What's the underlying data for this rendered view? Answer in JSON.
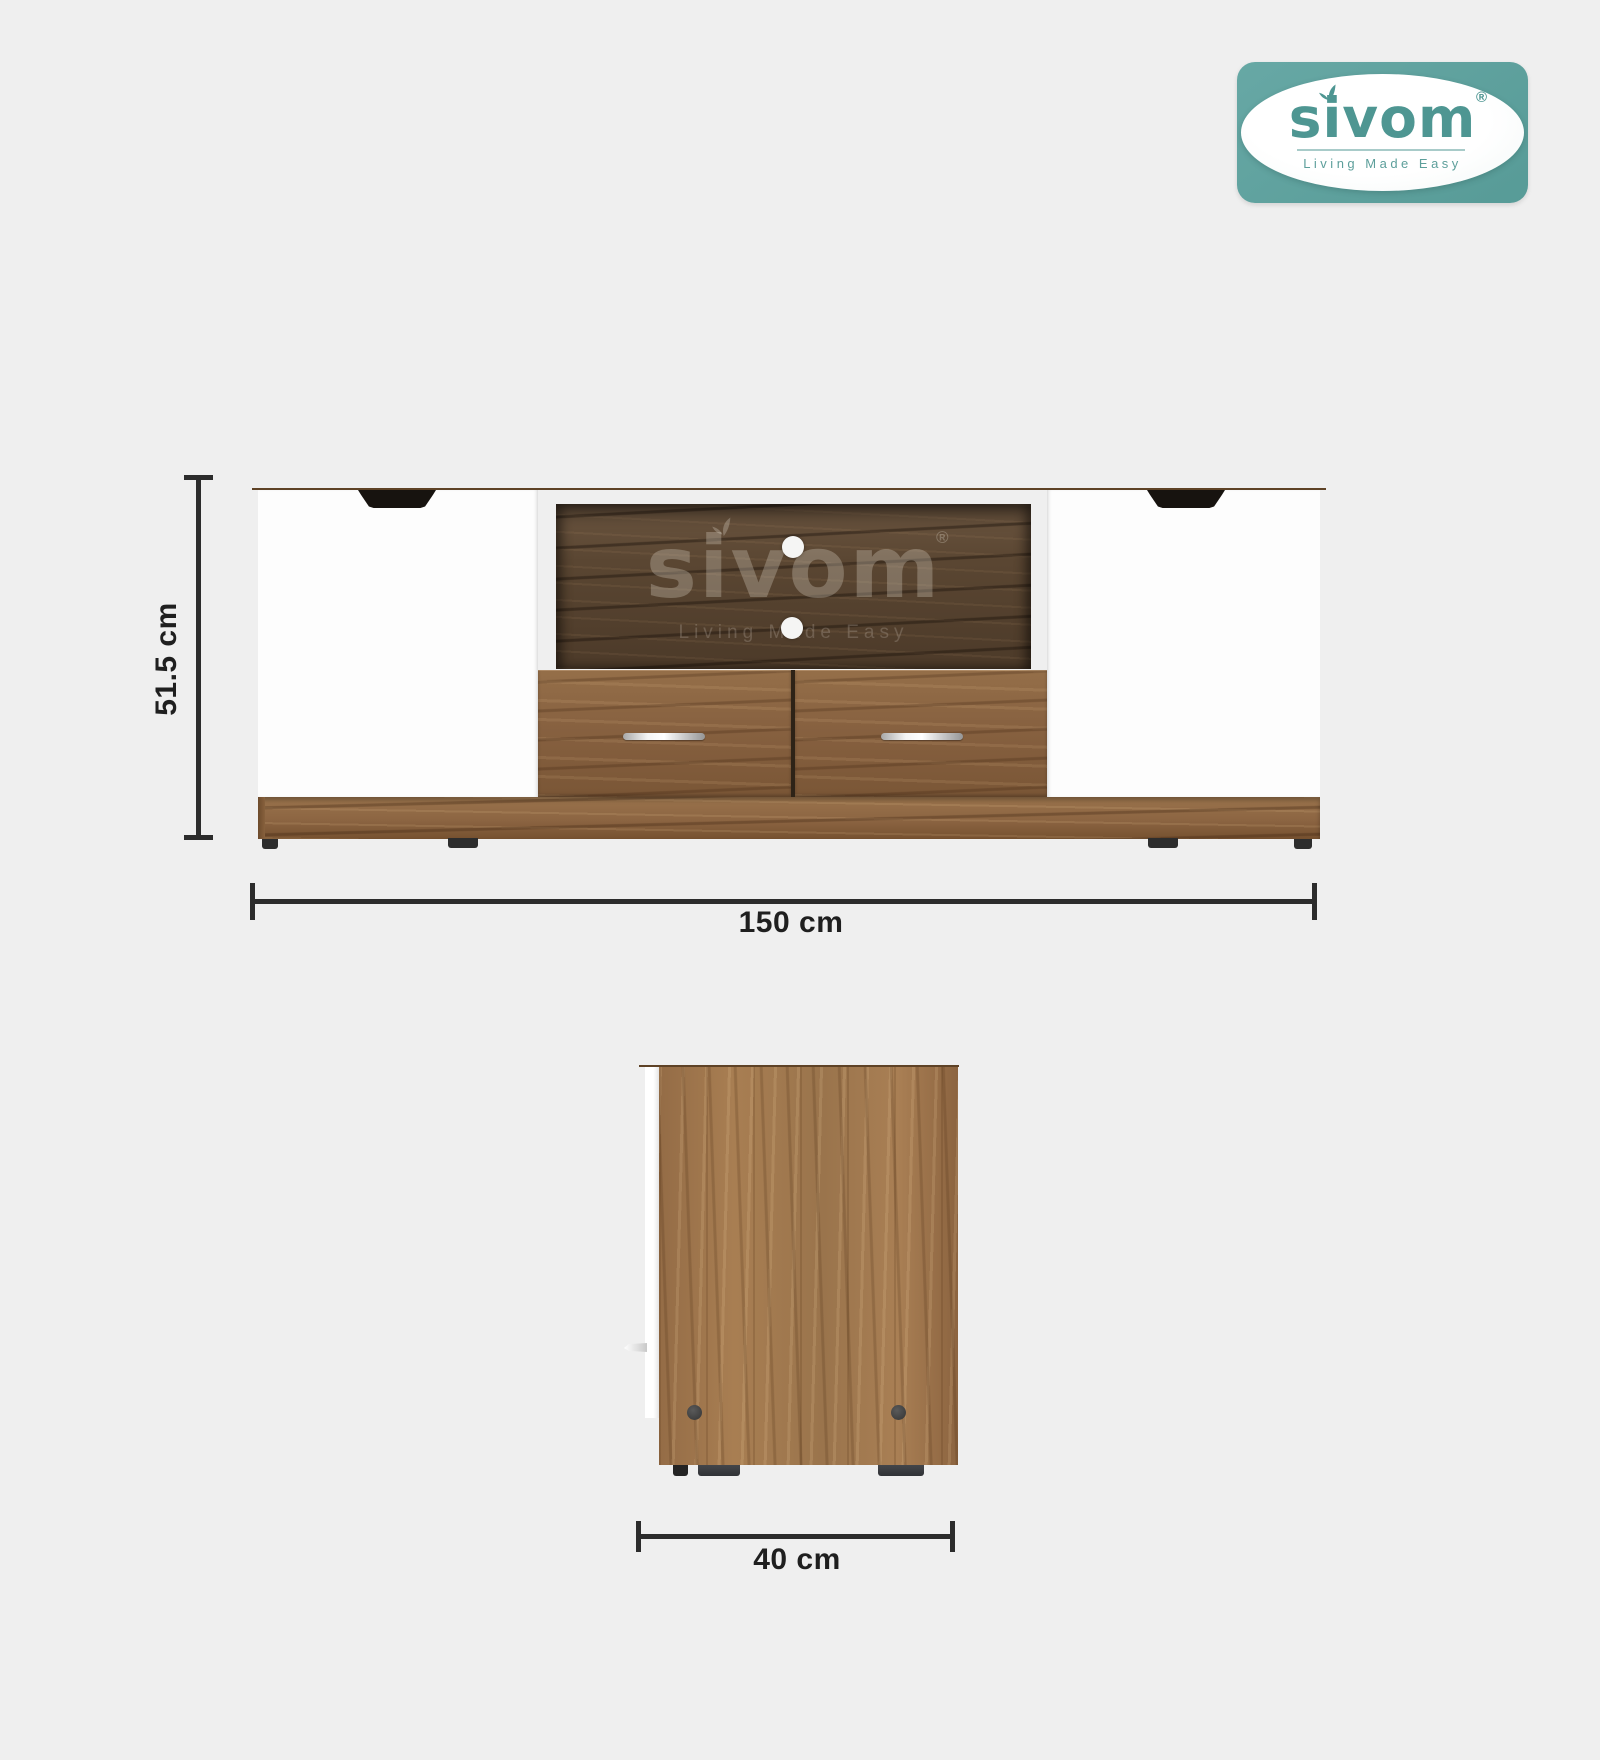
{
  "brand_logo": {
    "name": "sivom",
    "registered": "®",
    "tagline": "Living Made Easy",
    "teal": "#5fa3a0",
    "text_teal": "#4e9692"
  },
  "front_view": {
    "height_dim": "51.5 cm",
    "width_dim": "150 cm",
    "watermark": {
      "name": "sivom",
      "registered": "®",
      "tagline": "Living Made Easy"
    }
  },
  "side_view": {
    "depth_dim": "40 cm"
  },
  "icons": {
    "logo_leaf": "leaf-sprout",
    "watermark_leaf": "leaf-sprout"
  },
  "colors": {
    "background": "#efefef",
    "dimension_line": "#2c2c2c",
    "walnut_light": "#a87e52",
    "walnut_mid": "#8c6542",
    "walnut_dark": "#5a4632",
    "door_white": "#fdfdfd"
  }
}
